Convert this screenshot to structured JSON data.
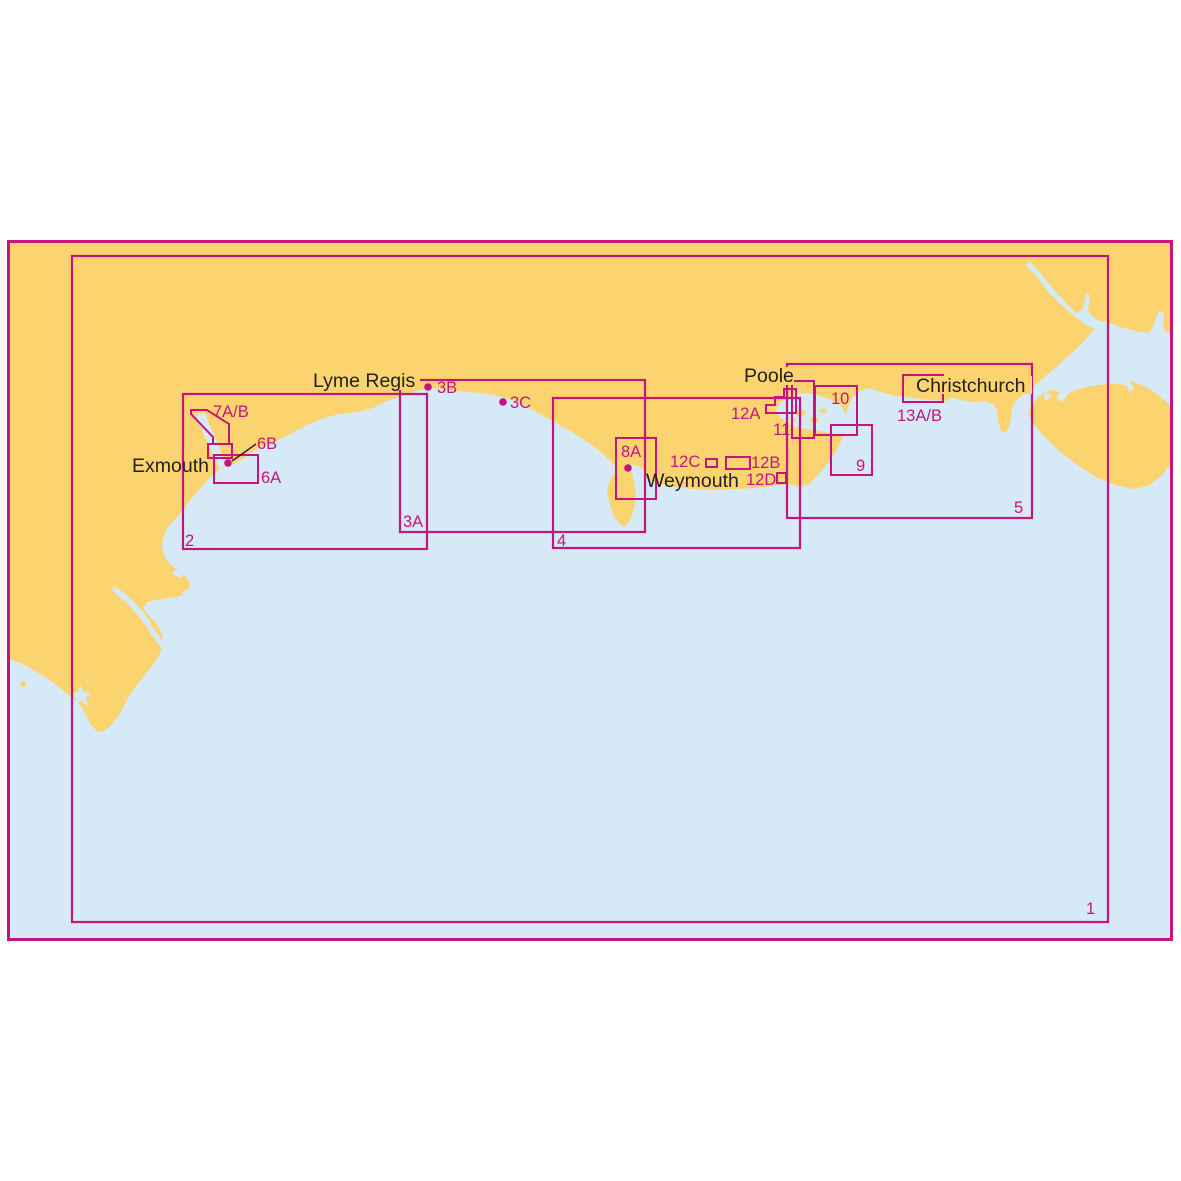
{
  "colors": {
    "land": "#FBD46F",
    "sea": "#D5E9F6",
    "line": "#C4157F",
    "ink": "#231F20",
    "page": "#FFFFFF"
  },
  "towns": {
    "exmouth": "Exmouth",
    "lyme_regis": "Lyme Regis",
    "weymouth": "Weymouth",
    "poole": "Poole",
    "christchurch": "Christchurch"
  },
  "charts": {
    "c1": "1",
    "c2": "2",
    "c3a": "3A",
    "c3b": "3B",
    "c3c": "3C",
    "c4": "4",
    "c5": "5",
    "c6a": "6A",
    "c6b": "6B",
    "c7ab": "7A/B",
    "c8a": "8A",
    "c9": "9",
    "c10": "10",
    "c11": "11",
    "c12a": "12A",
    "c12b": "12B",
    "c12c": "12C",
    "c12d": "12D",
    "c13ab": "13A/B"
  }
}
